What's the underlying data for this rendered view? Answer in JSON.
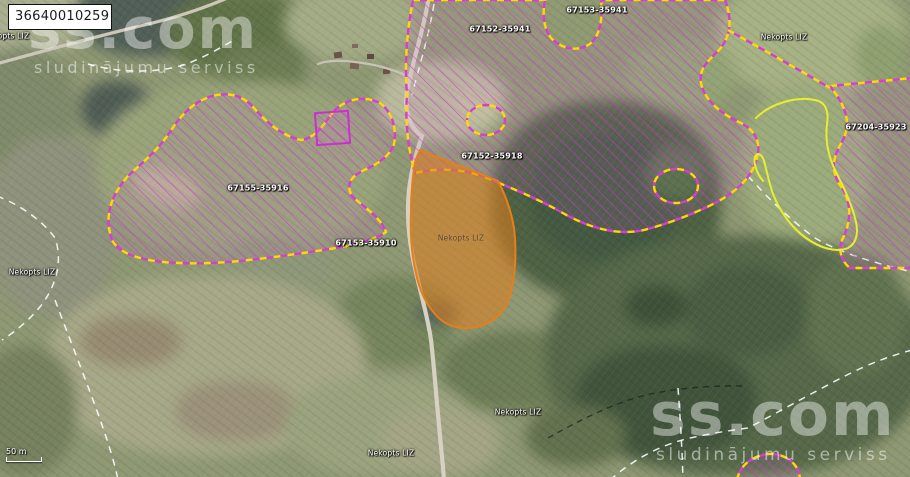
{
  "map": {
    "cadastral_number": "36640010259",
    "scale_bar": "50 m",
    "watermark": {
      "brand": "ss.com",
      "tagline": "sludinājumu serviss"
    },
    "labels": [
      {
        "text": "Nekopts LIZ",
        "kind": "landuse"
      },
      {
        "text": "67152-35941",
        "kind": "field-block"
      },
      {
        "text": "67153-35941",
        "kind": "field-block"
      },
      {
        "text": "Nekopts LIZ",
        "kind": "landuse"
      },
      {
        "text": "67155-35916",
        "kind": "field-block"
      },
      {
        "text": "67152-35918",
        "kind": "field-block"
      },
      {
        "text": "67153-35910",
        "kind": "field-block"
      },
      {
        "text": "Nekopts LIZ",
        "kind": "landuse-selected-parcel"
      },
      {
        "text": "Nekopts LIZ",
        "kind": "landuse"
      },
      {
        "text": "67204-35923",
        "kind": "field-block"
      },
      {
        "text": "Nekopts LIZ",
        "kind": "landuse"
      },
      {
        "text": "Nekopts LIZ",
        "kind": "landuse"
      }
    ],
    "colors": {
      "selected_parcel_fill": "#e27e1c",
      "selected_parcel_outline": "#e47f1a",
      "field_block_hatch": "#c13fc1",
      "block_border_yellow": "#ffd900",
      "block_border_magenta": "#d23fd2",
      "cadastral_line": "#ffffff",
      "parcel_outline_yellow": "#e6ef2e"
    }
  }
}
